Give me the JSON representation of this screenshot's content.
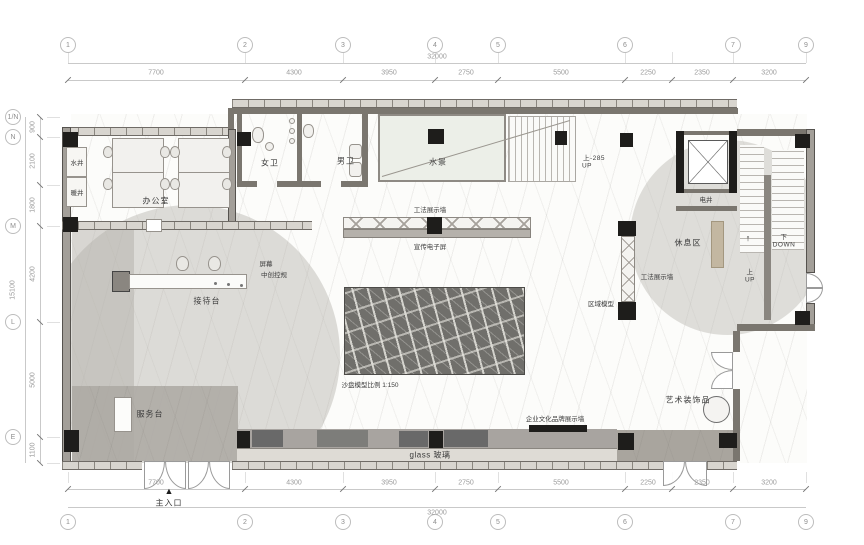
{
  "grid": {
    "top_bubbles": [
      "1",
      "2",
      "3",
      "4",
      "5",
      "6",
      "7",
      "9"
    ],
    "bottom_bubbles": [
      "1",
      "2",
      "3",
      "4",
      "5",
      "6",
      "7",
      "9"
    ],
    "left_bubbles": [
      "1/N",
      "N",
      "M",
      "L",
      "E"
    ],
    "col_dims": [
      "7700",
      "4300",
      "3950",
      "2750",
      "5500",
      "2250",
      "2350",
      "3200"
    ],
    "row_dims": [
      "900",
      "2100",
      "1800",
      "4200",
      "5000",
      "1100"
    ],
    "total_width": "32000",
    "total_height": "15100"
  },
  "labels": {
    "office": "办公室",
    "water_shaft": "水井",
    "heating_shaft": "暖井",
    "wc_women": "女卫",
    "wc_men": "男卫",
    "water_feature": "水景",
    "up_285_line1": "上-285",
    "up_285_line2": "UP",
    "elevator_shaft": "电井",
    "rest_area": "休息区",
    "method_wall_top": "工法展示墙",
    "promo_screen": "宣传电子屏",
    "screen_line1": "屏幕",
    "screen_line2": "中创控规",
    "reception_desk": "接待台",
    "sand_table_caption": "沙盘模型比例 1:150",
    "region_model": "区域模型",
    "method_wall_right": "工法展示墙",
    "art_decor": "艺术装饰品",
    "service_desk": "服务台",
    "brand_wall": "企业文化品牌展示墙",
    "glass_wall": "glass 玻璃",
    "main_entrance": "主入口",
    "stair_down_line1": "下",
    "stair_down_line2": "DOWN",
    "stair_up_line1": "上",
    "stair_up_line2": "UP"
  },
  "icons": {
    "entrance_arrow": "▲",
    "stair_arrow": "↑"
  },
  "colors": {
    "wall_dark": "#7a766f",
    "wall_fill": "#a39f99",
    "column_black": "#1e1d1b",
    "floor_gray": "#b2aea8",
    "pool_fill": "#ecefe8",
    "cabinet_dark": "#696969",
    "bench_tan": "#c3b7a1",
    "dim_text": "#9b9b9b",
    "label_text": "#3c3c3c"
  }
}
